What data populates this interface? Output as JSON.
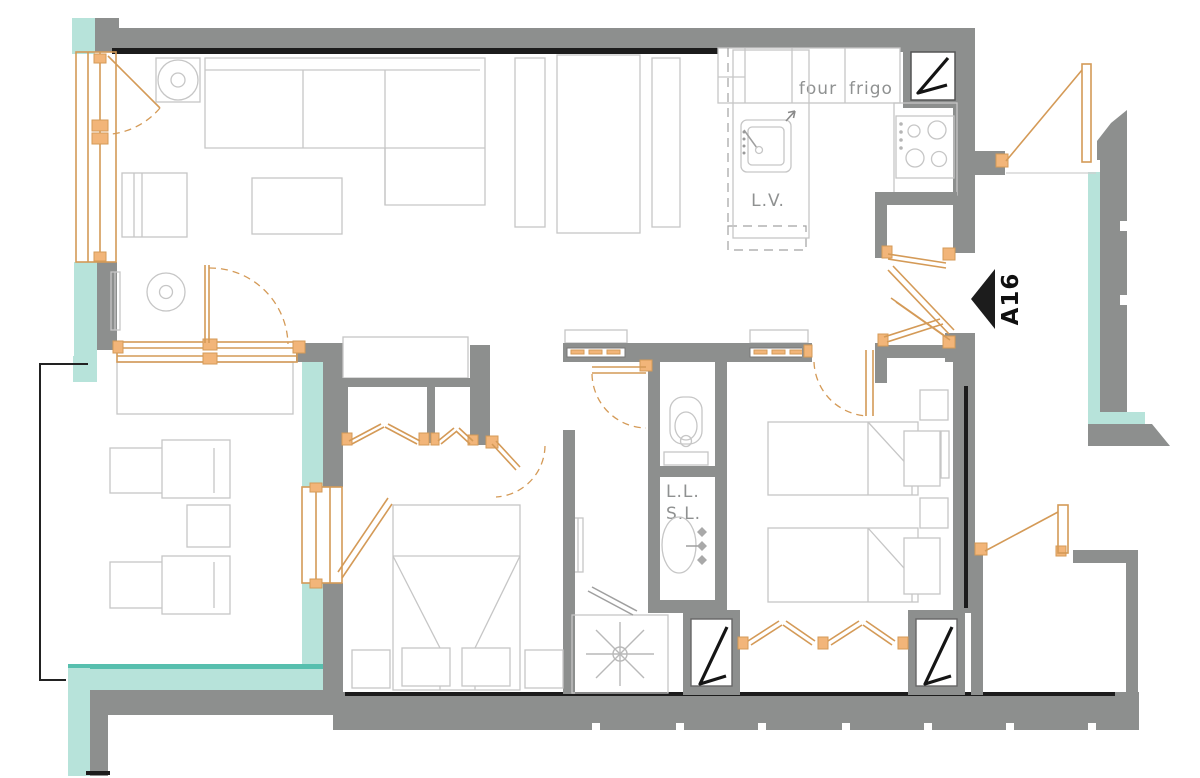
{
  "plan": {
    "unit_label": "A16",
    "labels": {
      "oven": "four",
      "fridge": "frigo",
      "dishwasher": "L.V.",
      "washing_machine": "L.L.",
      "dryer": "S.L."
    },
    "colors": {
      "wall": "#8d8f8e",
      "wall-dark": "#1c1c1c",
      "insulation": "#b7e3da",
      "insulation-edge": "#57bfae",
      "joinery": "#d49a57",
      "joinery-fill": "#f2b579",
      "furniture": "#c6c6c6",
      "label": "#8f9191"
    }
  }
}
